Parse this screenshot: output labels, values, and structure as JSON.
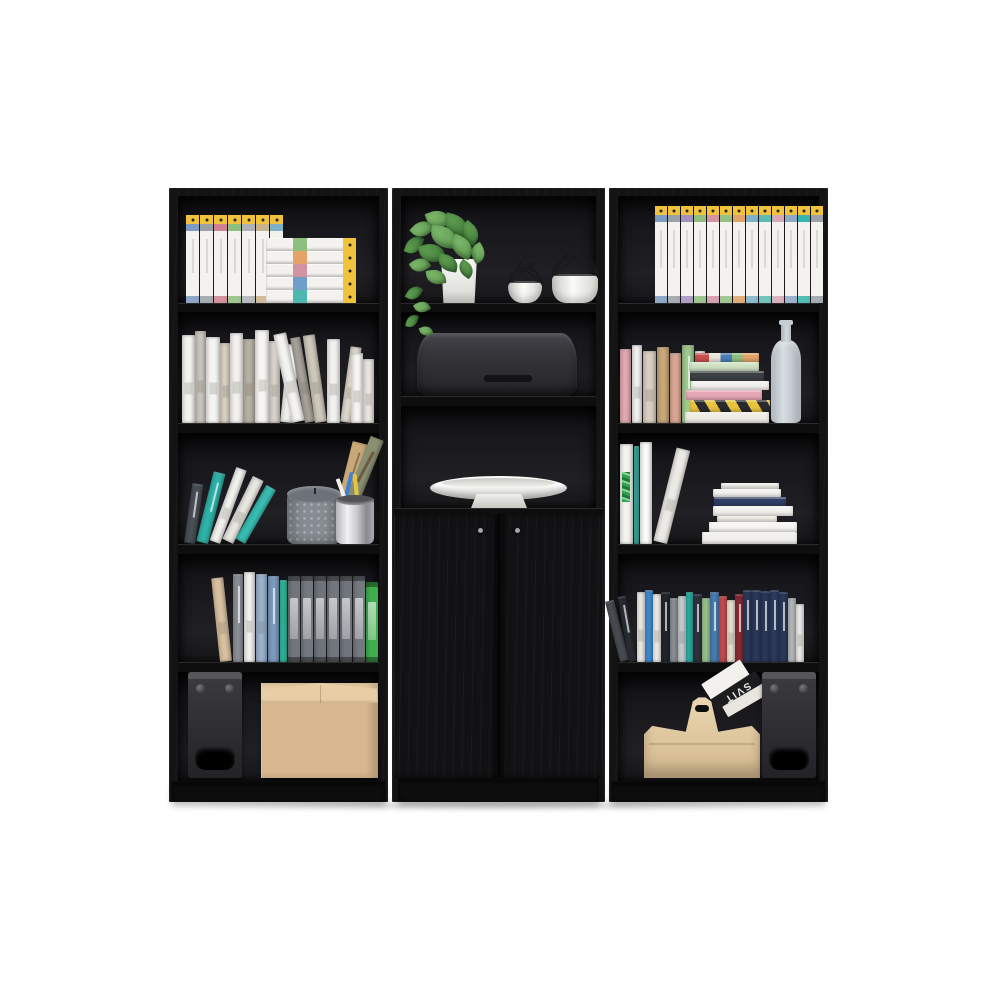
{
  "meta": {
    "subject": "Three-piece black engineered-wood bookcase wall unit product photo",
    "background": "#ffffff",
    "pieces": [
      "left open bookcase (5 shelves)",
      "center bookcase with 2-door storage cabinet",
      "right open bookcase (5 shelves)"
    ]
  },
  "palette": {
    "frame": "#141414",
    "binder_white": "#f3f2ee",
    "yellow": "#f1c23c",
    "kraft": "#d9b78e",
    "kraft_top": "#e9cda4",
    "teal": "#2fb3a9",
    "green": "#3fae4c",
    "candle": "#868c92",
    "candle_top": "#6c7278",
    "plant": "#5c9a4e",
    "plant_dark": "#3e7a39",
    "plant_light": "#79b469",
    "navy": "#2e3f66",
    "magazine_black": "#1d1d20"
  },
  "texts": {
    "magazine_spine": "SVIT"
  },
  "units": {
    "left": {
      "shelf1": {
        "objects": [
          "vertical white archive binders with yellow caps",
          "stacked lying archive binders"
        ],
        "vertical": {
          "w": 13,
          "h": 88,
          "bands": [
            "#7d9bc1",
            "#9aa0a8",
            "#d08090",
            "#8fbf7f",
            "#aeb2b6",
            "#c9b38c",
            "#7fb0c9"
          ]
        },
        "stacked": {
          "w": 90,
          "h": 13,
          "bands": [
            "#4db8b0",
            "#6f9fc8",
            "#d493a3",
            "#e2a268",
            "#8fbf7f"
          ]
        }
      },
      "shelf2": {
        "objects": [
          "row of white, beige and grey books"
        ],
        "books": [
          [
            13,
            88,
            "#f3f2ef",
            0,
            2
          ],
          [
            11,
            92,
            "#c9c5bd",
            0,
            2
          ],
          [
            14,
            86,
            "#f5f4f1",
            0,
            2
          ],
          [
            10,
            80,
            "#d9d2c4",
            0,
            2
          ],
          [
            13,
            90,
            "#f2f1ee",
            0,
            2
          ],
          [
            12,
            84,
            "#b7b1a5",
            0,
            2
          ],
          [
            14,
            93,
            "#f6f5f2",
            0,
            2
          ],
          [
            11,
            82,
            "#d8d3c9",
            0,
            2
          ],
          [
            12,
            78,
            "#efeeea",
            6,
            2
          ],
          [
            13,
            90,
            "#f4f3f0",
            -12,
            2
          ],
          [
            10,
            86,
            "#a9a49b",
            -10,
            2
          ],
          [
            12,
            88,
            "#cfc8bb",
            -8,
            2
          ],
          [
            13,
            84,
            "#f2f1ee",
            0,
            2
          ],
          [
            11,
            76,
            "#ddd7cc",
            8,
            2
          ],
          [
            12,
            70,
            "#f5f4f1",
            0,
            2
          ],
          [
            11,
            64,
            "#e9e6df",
            0,
            2
          ]
        ]
      },
      "shelf3": {
        "objects": [
          "leaning teal and white books",
          "grey dotted pillar candle",
          "chrome pencil cup with pencils and brushes",
          "two rustic vintage books"
        ],
        "lean_books": [
          [
            11,
            60,
            "#4a4f57",
            8,
            1
          ],
          [
            12,
            72,
            "#2fb3a9",
            14,
            1
          ],
          [
            11,
            78,
            "#f3f2ef",
            20,
            2
          ],
          [
            12,
            70,
            "#e9e7e1",
            26,
            2
          ],
          [
            11,
            62,
            "#39bdb3",
            30,
            0
          ]
        ]
      },
      "shelf4": {
        "objects": [
          "tan and patterned books",
          "six grey office binders",
          "green office binder"
        ],
        "books": [
          [
            12,
            84,
            "#d9c0a0",
            -6,
            2
          ],
          [
            10,
            88,
            "#8c9096",
            0,
            1
          ],
          [
            11,
            90,
            "#f2f1ee",
            0,
            2
          ],
          [
            11,
            88,
            "#9db4ce",
            0,
            2
          ],
          [
            11,
            86,
            "#7d9cc0",
            0,
            1
          ],
          [
            7,
            82,
            "#2fbfa0",
            0,
            0
          ],
          [
            12,
            86,
            "#70757b",
            0,
            4
          ],
          [
            12,
            86,
            "#73787e",
            0,
            4
          ],
          [
            12,
            86,
            "#6e7379",
            0,
            4
          ],
          [
            12,
            86,
            "#72777d",
            0,
            4
          ],
          [
            12,
            86,
            "#70757b",
            0,
            4
          ],
          [
            12,
            86,
            "#74797f",
            0,
            4
          ],
          [
            12,
            80,
            "#3fae4c",
            0,
            4
          ]
        ]
      },
      "shelf5": {
        "objects": [
          "black bookshelf speaker with round driver and port",
          "kraft cardboard storage box"
        ]
      }
    },
    "center": {
      "shelf1": {
        "objects": [
          "pothos plant in white box planter with trailing vine",
          "small geometric wire-top vase",
          "large geometric wire-top vase"
        ]
      },
      "shelf2": {
        "objects": [
          "black rounded soundbar speaker"
        ]
      },
      "shelf3": {
        "objects": [
          "white pedestal fruit bowl"
        ]
      },
      "cabinet": {
        "objects": [
          "two flat cabinet doors",
          "two round metal knobs"
        ]
      }
    },
    "right": {
      "shelf1": {
        "objects": [
          "full row of thirteen white archive binders with yellow caps"
        ],
        "row": {
          "w": 12,
          "h": 97,
          "bands": [
            "#7d9bc1",
            "#9aa0a8",
            "#a58fc0",
            "#8fbf7f",
            "#d493a3",
            "#94c084",
            "#e2a268",
            "#7fb0c9",
            "#5bbcb4",
            "#d4a9b5",
            "#8fa8c8",
            "#35b5ab",
            "#9aa1a9"
          ]
        }
      },
      "shelf2": {
        "objects": [
          "row of pastel paperbacks",
          "horizontal stack of eight books incl. yellow-black striped spine",
          "tall grey-blue glass bottle vase"
        ],
        "books": [
          [
            11,
            74,
            "#e2aab4",
            0,
            0
          ],
          [
            10,
            78,
            "#f3f2ef",
            0,
            2
          ],
          [
            13,
            72,
            "#d9cfc0",
            0,
            2
          ],
          [
            12,
            76,
            "#c9a878",
            0,
            0
          ],
          [
            11,
            70,
            "#dba896",
            0,
            0
          ],
          [
            12,
            78,
            "#9fc98f",
            0,
            1
          ],
          [
            10,
            72,
            "#f5f4f1",
            0,
            2
          ],
          [
            11,
            66,
            "#b9bdc1",
            0,
            0
          ]
        ],
        "stack": [
          [
            84,
            11,
            "#efece6"
          ],
          [
            80,
            12,
            "hazard"
          ],
          [
            76,
            10,
            "#e7a8b8"
          ],
          [
            78,
            9,
            "#f2f1ee"
          ],
          [
            74,
            10,
            "#3c4043"
          ],
          [
            70,
            9,
            "#cfe3c4"
          ],
          [
            64,
            9,
            "multi"
          ]
        ]
      },
      "shelf3": {
        "objects": [
          "large leaning white books, one with green graffiti cover",
          "stack of white books with one navy spine"
        ],
        "lean_books": [
          [
            13,
            100,
            "#f4f3f0",
            0,
            3
          ],
          [
            5,
            98,
            "#3ab5ac",
            0,
            0
          ],
          [
            12,
            102,
            "#fbfaf8",
            0,
            0
          ],
          [
            14,
            96,
            "#eceae5",
            14,
            2
          ]
        ],
        "stack": [
          [
            95,
            12,
            "#f2f1ee"
          ],
          [
            88,
            10,
            "#f6f5f2"
          ],
          [
            60,
            6,
            "#efece4"
          ],
          [
            80,
            10,
            "#f2f1ee"
          ],
          [
            72,
            9,
            "#2e3f66"
          ],
          [
            68,
            8,
            "#f4f3f0"
          ],
          [
            58,
            6,
            "#eeece6"
          ]
        ]
      },
      "shelf4": {
        "objects": [
          "dense row of mixed novels with navy boxed set at right"
        ],
        "books": [
          [
            9,
            62,
            "#4a4e54",
            -14,
            0
          ],
          [
            8,
            66,
            "#2b2f35",
            -10,
            1
          ],
          [
            8,
            70,
            "#f2f1ee",
            0,
            2
          ],
          [
            8,
            72,
            "#3f8fd4",
            0,
            0
          ],
          [
            8,
            68,
            "#f4f3f0",
            0,
            2
          ],
          [
            9,
            70,
            "#23272d",
            0,
            1
          ],
          [
            8,
            64,
            "#8f949b",
            0,
            0
          ],
          [
            8,
            66,
            "#cfd3d8",
            0,
            2
          ],
          [
            7,
            70,
            "#2fb3a9",
            0,
            0
          ],
          [
            9,
            68,
            "#2e3440",
            0,
            1
          ],
          [
            8,
            64,
            "#9fc98f",
            0,
            0
          ],
          [
            9,
            70,
            "#4a7fb5",
            0,
            1
          ],
          [
            8,
            66,
            "#c95050",
            0,
            0
          ],
          [
            8,
            62,
            "#efe9da",
            0,
            2
          ],
          [
            8,
            68,
            "#8a2f35",
            0,
            1
          ],
          [
            9,
            72,
            "#2b3a5c",
            0,
            1
          ],
          [
            9,
            72,
            "#2c3b5e",
            0,
            1
          ],
          [
            9,
            71,
            "#2b3a5c",
            0,
            1
          ],
          [
            9,
            72,
            "#2d3c60",
            0,
            1
          ],
          [
            9,
            70,
            "#2b3a5c",
            0,
            1
          ],
          [
            8,
            64,
            "#b9bdc1",
            0,
            0
          ],
          [
            8,
            58,
            "#f2f1ee",
            0,
            2
          ]
        ]
      },
      "shelf5": {
        "objects": [
          "light wood carry basket with handle",
          "magazines leaning out of basket",
          "black bookshelf speaker"
        ]
      }
    }
  }
}
